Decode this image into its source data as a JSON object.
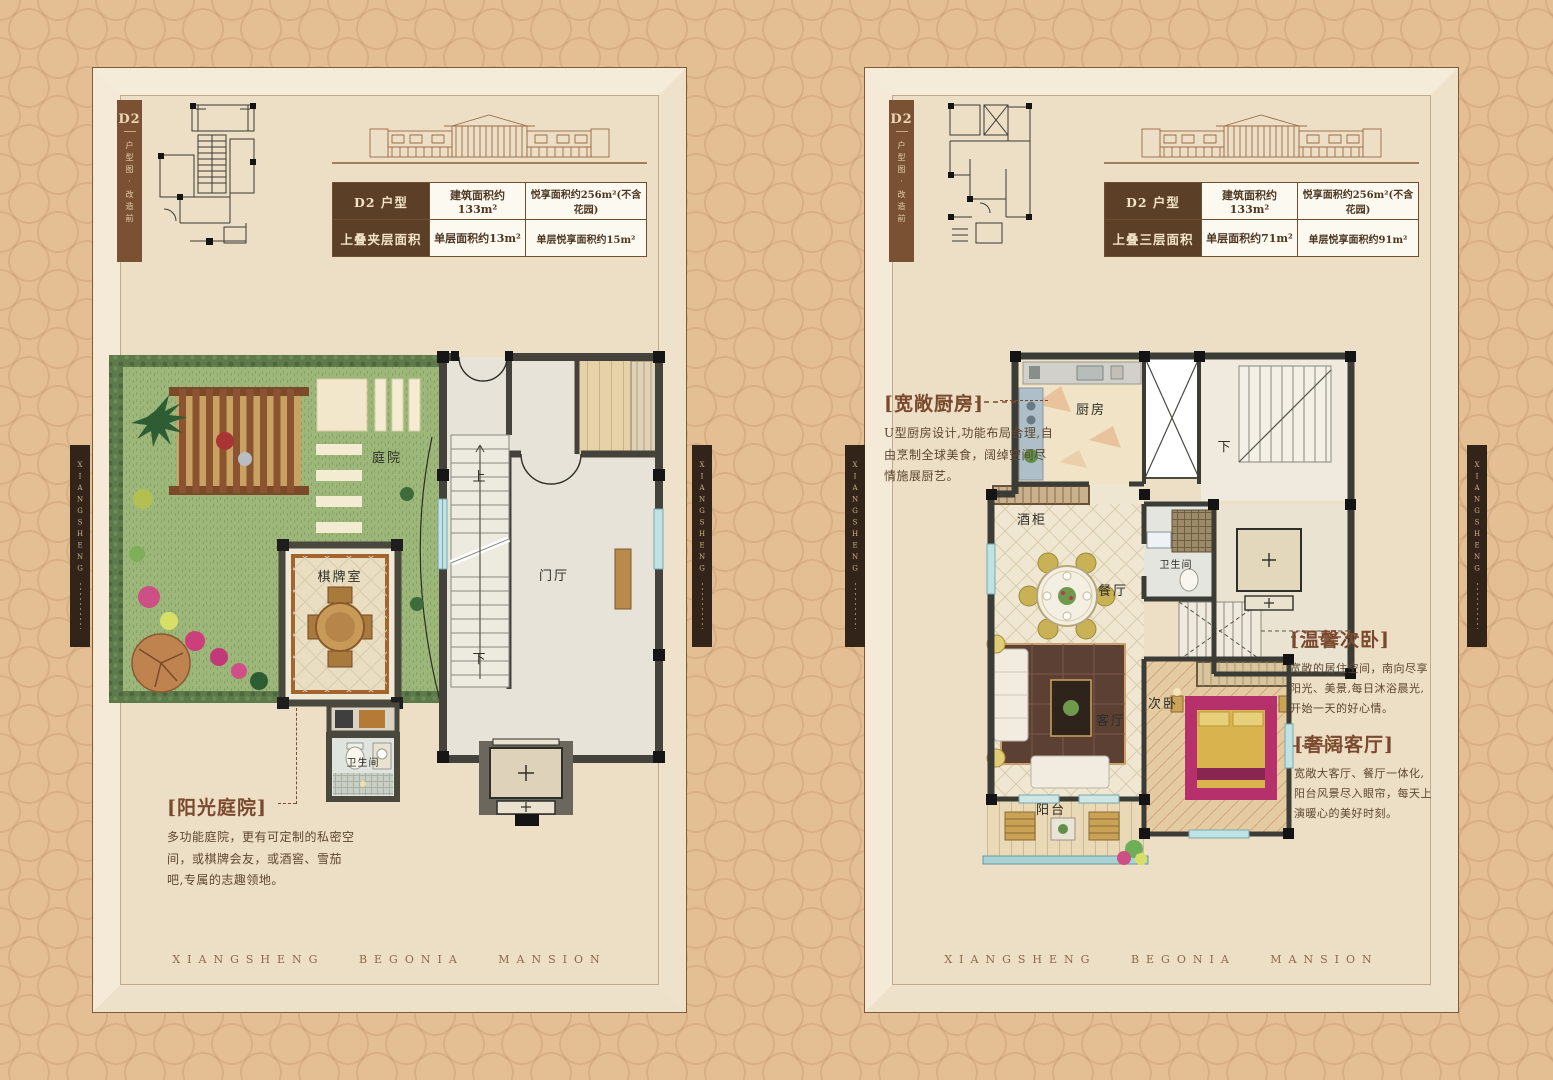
{
  "brand": {
    "side_label": "XIANGSHENG",
    "footer": "XIANGSHENG BEGONIA MANSION"
  },
  "colors": {
    "page_bg": "#e4bf93",
    "panel_bg": "#ecdfc6",
    "table_head_bg": "#5c3f27",
    "accent_brown": "#7b4a2e",
    "side_bar_bg": "#33241a",
    "lawn_green": "#9db77b"
  },
  "panels": {
    "left": {
      "thumb": {
        "unit": "D2",
        "caption": "户型图·改造前"
      },
      "table": {
        "rows": [
          {
            "head": "D2 户型",
            "col1": "建筑面积约133m²",
            "col2": "悦享面积约256m²(不含花园)"
          },
          {
            "head": "上叠夹层面积",
            "col1": "单层面积约13m²",
            "col2": "单层悦享面积约15m²"
          }
        ]
      },
      "plan_labels": {
        "courtyard": "庭院",
        "chess_room": "棋牌室",
        "foyer": "门厅",
        "bathroom": "卫生间",
        "stair_up": "上",
        "stair_down": "下"
      },
      "annotations": [
        {
          "title": "[阳光庭院]",
          "body": "多功能庭院，更有可定制的私密空间，或棋牌会友，或酒窖、雪茄吧,专属的志趣领地。"
        }
      ]
    },
    "right": {
      "thumb": {
        "unit": "D2",
        "caption": "户型图·改造前"
      },
      "table": {
        "rows": [
          {
            "head": "D2 户型",
            "col1": "建筑面积约133m²",
            "col2": "悦享面积约256m²(不含花园)"
          },
          {
            "head": "上叠三层面积",
            "col1": "单层面积约71m²",
            "col2": "单层悦享面积约91m²"
          }
        ]
      },
      "plan_labels": {
        "kitchen": "厨房",
        "wine_cabinet": "酒柜",
        "dining": "餐厅",
        "bathroom": "卫生间",
        "living": "客厅",
        "bedroom": "次卧",
        "balcony": "阳台",
        "stair_down": "下"
      },
      "annotations": [
        {
          "title": "[宽敞厨房]",
          "body": "U型厨房设计,功能布局合理,自由烹制全球美食，阔绰空间尽情施展厨艺。"
        },
        {
          "title": "[温馨次卧]",
          "body": "宽敞的居住空间，南向尽享阳光、美景,每日沐浴晨光,开始一天的好心情。"
        },
        {
          "title": "[奢阔客厅]",
          "body": "宽敞大客厅、餐厅一体化,阳台风景尽入眼帘，每天上演暖心的美好时刻。"
        }
      ]
    }
  }
}
